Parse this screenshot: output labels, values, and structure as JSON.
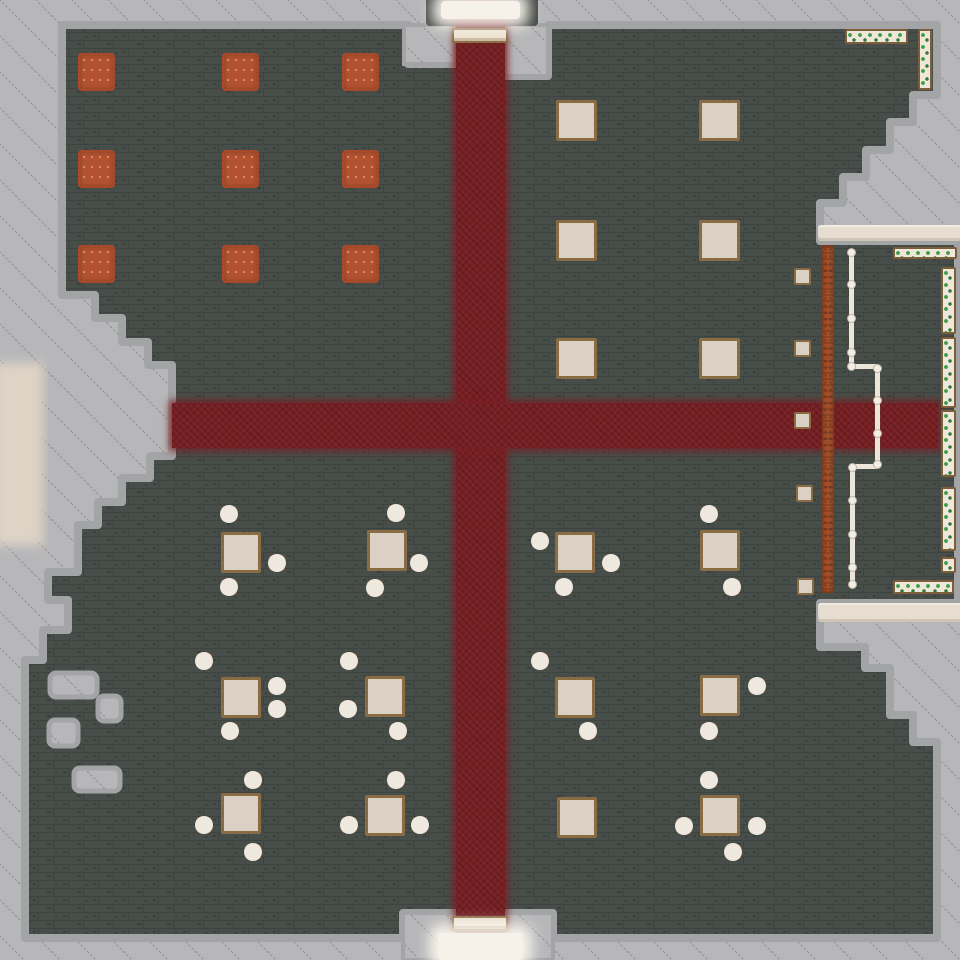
{
  "scene": {
    "kind": "top-down-tavern-map",
    "colors": {
      "outside": "#b7b7b9",
      "hatch_line": "#8d8d8f",
      "fringe": "#a2a4a6",
      "floor": "#474d49",
      "brick_line": "#3d433f",
      "brick_dark": "#3a403c",
      "carpet": "#7d2327",
      "rug": "#b35231",
      "rug_border": "#a8492a",
      "table": "#dbd0c4",
      "furniture_border": "#8a6c44",
      "stool_seat": "#efe8de",
      "wall_band": "#e6ddd0",
      "bar": "#a14f2b",
      "bar_border": "#7c3a1e",
      "fence": "#ece5d9",
      "fence_knob": "#f3ede3",
      "planter_box": "#efe8da",
      "planter_border": "#7d5e3a",
      "vine": "#3f9e48",
      "vine_dark": "#2d7a37",
      "door": "#f7f2e9",
      "doormat": "#ece2d2",
      "left_glow": "#ded3c5",
      "door_frame": "#3f4441"
    },
    "sizes": {
      "rug": [
        37,
        38
      ],
      "table": [
        41,
        41
      ],
      "dining_table": [
        40,
        41
      ],
      "stool": 16,
      "mini_table": 17
    },
    "carpets": {
      "vertical": {
        "x": 456,
        "y": 0,
        "w": 49,
        "h": 960
      },
      "horizontal": {
        "x": 172,
        "y": 403,
        "w": 766,
        "h": 45
      }
    },
    "rugs": [
      [
        78,
        53
      ],
      [
        222,
        53
      ],
      [
        342,
        53
      ],
      [
        78,
        150
      ],
      [
        222,
        150
      ],
      [
        342,
        150
      ],
      [
        78,
        245
      ],
      [
        222,
        245
      ],
      [
        342,
        245
      ]
    ],
    "plain_tables": [
      [
        556,
        100
      ],
      [
        699,
        100
      ],
      [
        556,
        220
      ],
      [
        699,
        220
      ],
      [
        556,
        338
      ],
      [
        699,
        338
      ]
    ],
    "dining_sets": [
      {
        "table": [
          221,
          532
        ],
        "stools": [
          [
            229,
            514
          ],
          [
            277,
            563
          ],
          [
            229,
            587
          ]
        ]
      },
      {
        "table": [
          367,
          530
        ],
        "stools": [
          [
            396,
            513
          ],
          [
            419,
            563
          ],
          [
            375,
            588
          ]
        ]
      },
      {
        "table": [
          221,
          677
        ],
        "stools": [
          [
            204,
            661
          ],
          [
            277,
            686
          ],
          [
            277,
            709
          ],
          [
            230,
            731
          ]
        ]
      },
      {
        "table": [
          365,
          676
        ],
        "stools": [
          [
            349,
            661
          ],
          [
            348,
            709
          ],
          [
            398,
            731
          ]
        ]
      },
      {
        "table": [
          221,
          793
        ],
        "stools": [
          [
            253,
            780
          ],
          [
            204,
            825
          ],
          [
            253,
            852
          ]
        ]
      },
      {
        "table": [
          365,
          795
        ],
        "stools": [
          [
            396,
            780
          ],
          [
            349,
            825
          ],
          [
            420,
            825
          ]
        ]
      },
      {
        "table": [
          555,
          532
        ],
        "stools": [
          [
            540,
            541
          ],
          [
            611,
            563
          ],
          [
            564,
            587
          ]
        ]
      },
      {
        "table": [
          700,
          530
        ],
        "stools": [
          [
            709,
            514
          ],
          [
            732,
            587
          ]
        ]
      },
      {
        "table": [
          555,
          677
        ],
        "stools": [
          [
            540,
            661
          ],
          [
            588,
            731
          ]
        ]
      },
      {
        "table": [
          700,
          675
        ],
        "stools": [
          [
            757,
            686
          ],
          [
            709,
            731
          ]
        ]
      },
      {
        "table": [
          557,
          797
        ],
        "stools": []
      },
      {
        "table": [
          700,
          795
        ],
        "stools": [
          [
            709,
            780
          ],
          [
            684,
            826
          ],
          [
            757,
            826
          ],
          [
            733,
            852
          ]
        ]
      }
    ],
    "mini_tables": [
      [
        794,
        268
      ],
      [
        794,
        340
      ],
      [
        794,
        412
      ],
      [
        796,
        485
      ],
      [
        797,
        578
      ]
    ],
    "bar": {
      "x": 822,
      "y": 245,
      "w": 12,
      "h": 348
    },
    "fence": {
      "segments": [
        {
          "x": 849,
          "y": 252,
          "w": 5,
          "h": 116
        },
        {
          "x": 849,
          "y": 364,
          "w": 30,
          "h": 5
        },
        {
          "x": 875,
          "y": 366,
          "w": 5,
          "h": 100
        },
        {
          "x": 850,
          "y": 464,
          "w": 29,
          "h": 5
        },
        {
          "x": 850,
          "y": 466,
          "w": 5,
          "h": 119
        }
      ],
      "posts": [
        [
          851,
          252
        ],
        [
          851,
          284
        ],
        [
          851,
          318
        ],
        [
          851,
          352
        ],
        [
          851,
          366
        ],
        [
          877,
          368
        ],
        [
          877,
          400
        ],
        [
          877,
          433
        ],
        [
          877,
          464
        ],
        [
          852,
          467
        ],
        [
          852,
          500
        ],
        [
          852,
          534
        ],
        [
          852,
          567
        ],
        [
          852,
          584
        ]
      ]
    },
    "planters": [
      {
        "x": 845,
        "y": 29,
        "w": 63,
        "h": 15
      },
      {
        "x": 918,
        "y": 29,
        "w": 14,
        "h": 61
      },
      {
        "x": 893,
        "y": 247,
        "w": 64,
        "h": 12
      },
      {
        "x": 941,
        "y": 267,
        "w": 15,
        "h": 67
      },
      {
        "x": 941,
        "y": 337,
        "w": 15,
        "h": 71
      },
      {
        "x": 941,
        "y": 410,
        "w": 15,
        "h": 67
      },
      {
        "x": 941,
        "y": 487,
        "w": 15,
        "h": 64
      },
      {
        "x": 941,
        "y": 557,
        "w": 15,
        "h": 16
      },
      {
        "x": 893,
        "y": 580,
        "w": 61,
        "h": 14
      }
    ],
    "wall_bands": [
      {
        "x": 818,
        "y": 225,
        "w": 142,
        "h": 16
      },
      {
        "x": 818,
        "y": 603,
        "w": 142,
        "h": 19
      }
    ],
    "doormats": [
      {
        "x": 452,
        "y": 28,
        "w": 56,
        "h": 15
      },
      {
        "x": 452,
        "y": 916,
        "w": 56,
        "h": 15
      }
    ],
    "doors": {
      "top": {
        "x": 441,
        "y": 1,
        "w": 79,
        "h": 18
      },
      "bottom": {
        "x": 438,
        "y": 933,
        "w": 85,
        "h": 27
      }
    }
  }
}
